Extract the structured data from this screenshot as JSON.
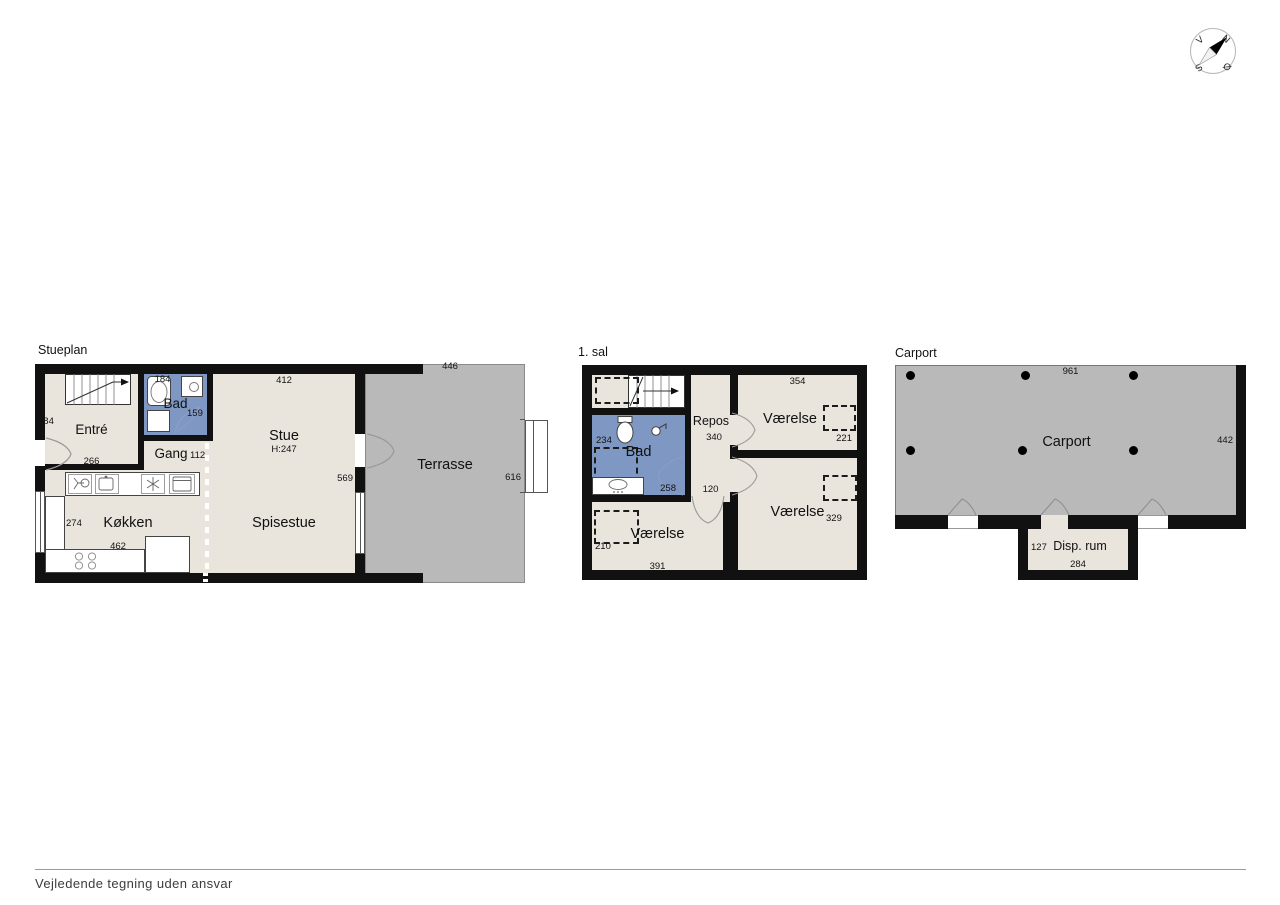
{
  "footer": {
    "disclaimer": "Vejledende tegning uden ansvar"
  },
  "compass": {
    "west": "V",
    "north": "N",
    "south": "S",
    "east": "Ø"
  },
  "plans": {
    "stueplan": {
      "title": "Stueplan",
      "rooms": {
        "entre": "Entré",
        "bad": "Bad",
        "gang": "Gang",
        "stue": "Stue",
        "stue_height": "H:247",
        "spisestue": "Spisestue",
        "kokken": "Køkken",
        "terrasse": "Terrasse"
      },
      "dims": {
        "entre_left": "284",
        "entre_bottom": "266",
        "bad_top": "184",
        "bad_door": "159",
        "gang_right": "112",
        "stue_top": "412",
        "stue_right": "569",
        "kokken_left": "274",
        "kokken_bottom": "462",
        "terrasse_top": "446",
        "terrasse_right": "616"
      }
    },
    "first_floor": {
      "title": "1. sal",
      "rooms": {
        "bad": "Bad",
        "repos": "Repos",
        "vaerelse_tr": "Værelse",
        "vaerelse_br": "Værelse",
        "vaerelse_bl": "Værelse"
      },
      "dims": {
        "bad_left": "234",
        "bad_bottom": "258",
        "repos_mid": "340",
        "repos_bottom": "120",
        "vaerelse_tr_top": "354",
        "vaerelse_tr_right": "221",
        "vaerelse_br_right": "329",
        "vaerelse_bl_left": "210",
        "vaerelse_bl_bottom": "391"
      }
    },
    "carport": {
      "title": "Carport",
      "rooms": {
        "carport": "Carport",
        "disp_rum": "Disp. rum"
      },
      "dims": {
        "top": "961",
        "right": "442",
        "disp_left": "127",
        "disp_bottom": "284"
      }
    }
  }
}
